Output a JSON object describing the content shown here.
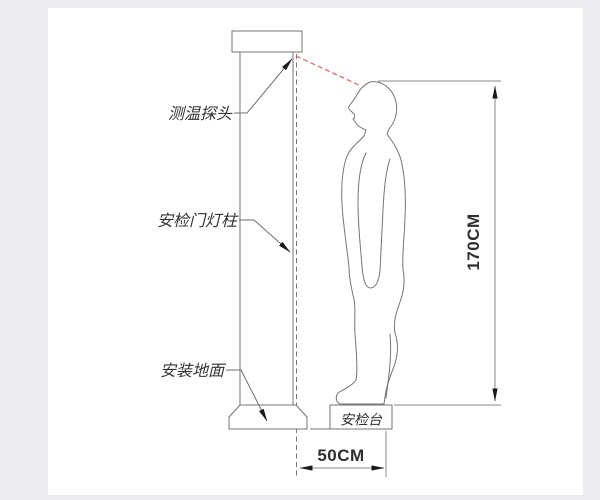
{
  "page": {
    "background_color": "#ececee",
    "canvas_color": "#ffffff"
  },
  "diagram": {
    "type": "installation-diagram",
    "subject": "security gate with temperature probe and standing person",
    "labels": {
      "probe": "测温探头",
      "pole": "安检门灯柱",
      "ground": "安装地面",
      "platform": "安检台"
    },
    "dimensions": {
      "person_height": "170CM",
      "gate_distance": "50CM"
    },
    "colors": {
      "outline": "#757575",
      "dimension_line": "#8a8a8a",
      "arrow": "#1a1a1a",
      "beam": "#dd6a6a",
      "label_text": "#333333",
      "dimension_text": "#2e2e2e"
    }
  }
}
